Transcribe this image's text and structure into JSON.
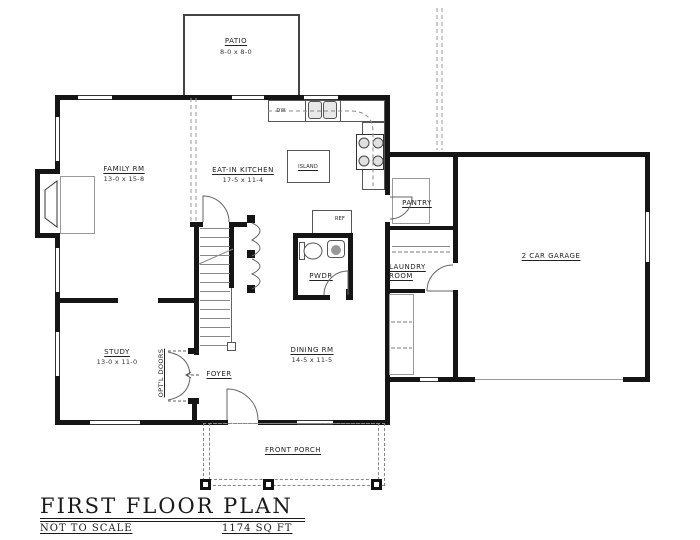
{
  "title_block": {
    "title": "FIRST FLOOR PLAN",
    "scale_note": "NOT TO SCALE",
    "area": "1174 SQ FT"
  },
  "rooms": {
    "patio": {
      "name": "PATIO",
      "dims": "8-0 x 8-0"
    },
    "family": {
      "name": "FAMILY RM",
      "dims": "13-0 x 15-8"
    },
    "kitchen": {
      "name": "EAT-IN KITCHEN",
      "dims": "17-5 x 11-4"
    },
    "pantry": {
      "name": "PANTRY"
    },
    "laundry": {
      "line1": "LAUNDRY",
      "line2": "ROOM"
    },
    "garage": {
      "name": "2 CAR GARAGE"
    },
    "powder": {
      "name": "PWDR"
    },
    "study": {
      "name": "STUDY",
      "dims": "13-0 x 11-0"
    },
    "dining": {
      "name": "DINING RM",
      "dims": "14-5 x 11-5"
    },
    "foyer": {
      "name": "FOYER"
    },
    "porch": {
      "name": "FRONT PORCH"
    }
  },
  "fixtures": {
    "island": "ISLAND",
    "dishwasher": "DW",
    "refrigerator": "REF",
    "optional_doors": "OPT'L DOORS"
  },
  "colors": {
    "wall": "#151515",
    "line": "#555555",
    "accent_gray": "#888888"
  }
}
